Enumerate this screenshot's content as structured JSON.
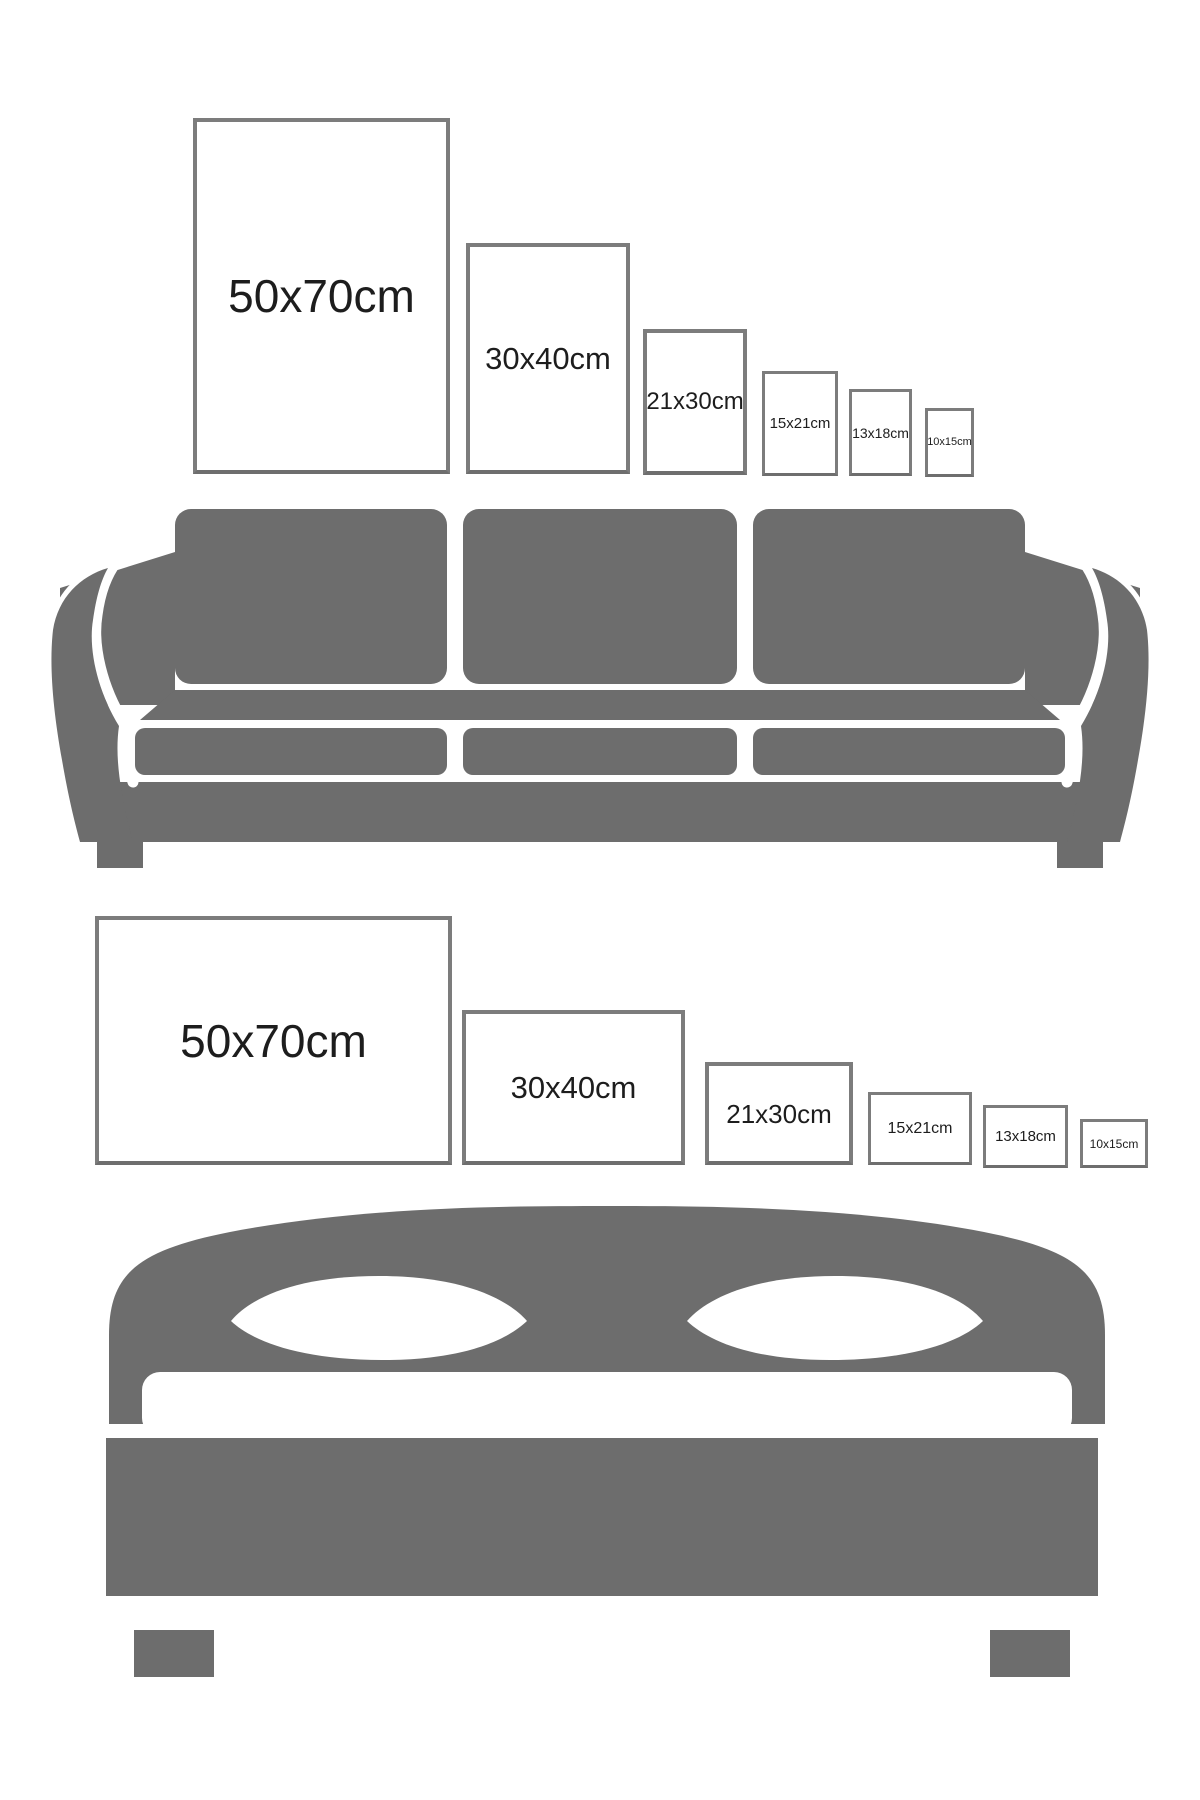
{
  "colors": {
    "background": "#ffffff",
    "furniture_gray": "#6d6d6d",
    "frame_border_gray": "#7c7c7c",
    "frame_border_dark": "#6e6e6e",
    "label_text": "#1d1d1d"
  },
  "sections": [
    {
      "name": "poster sizes above sofa",
      "furniture": "sofa",
      "orientation": "portrait",
      "frames": [
        {
          "label": "50x70cm"
        },
        {
          "label": "30x40cm"
        },
        {
          "label": "21x30cm"
        },
        {
          "label": "15x21cm"
        },
        {
          "label": "13x18cm"
        },
        {
          "label": "10x15cm"
        }
      ]
    },
    {
      "name": "poster sizes above bed",
      "furniture": "bed",
      "orientation": "landscape",
      "frames": [
        {
          "label": "50x70cm"
        },
        {
          "label": "30x40cm"
        },
        {
          "label": "21x30cm"
        },
        {
          "label": "15x21cm"
        },
        {
          "label": "13x18cm"
        },
        {
          "label": "10x15cm"
        }
      ]
    }
  ]
}
